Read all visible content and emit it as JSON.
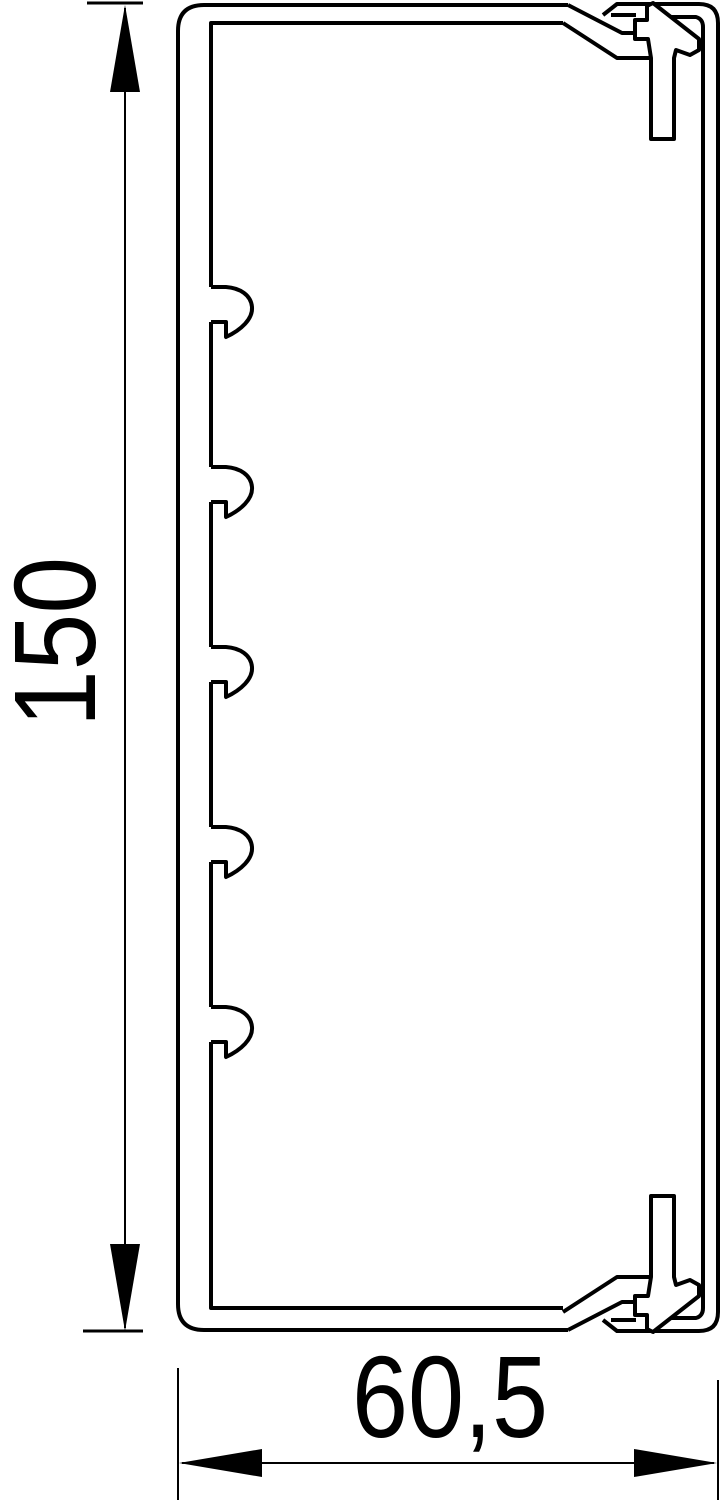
{
  "diagram": {
    "height_dimension": {
      "value": "150"
    },
    "width_dimension": {
      "value": "60,5"
    },
    "line_color": "#000000",
    "background_color": "#ffffff"
  }
}
